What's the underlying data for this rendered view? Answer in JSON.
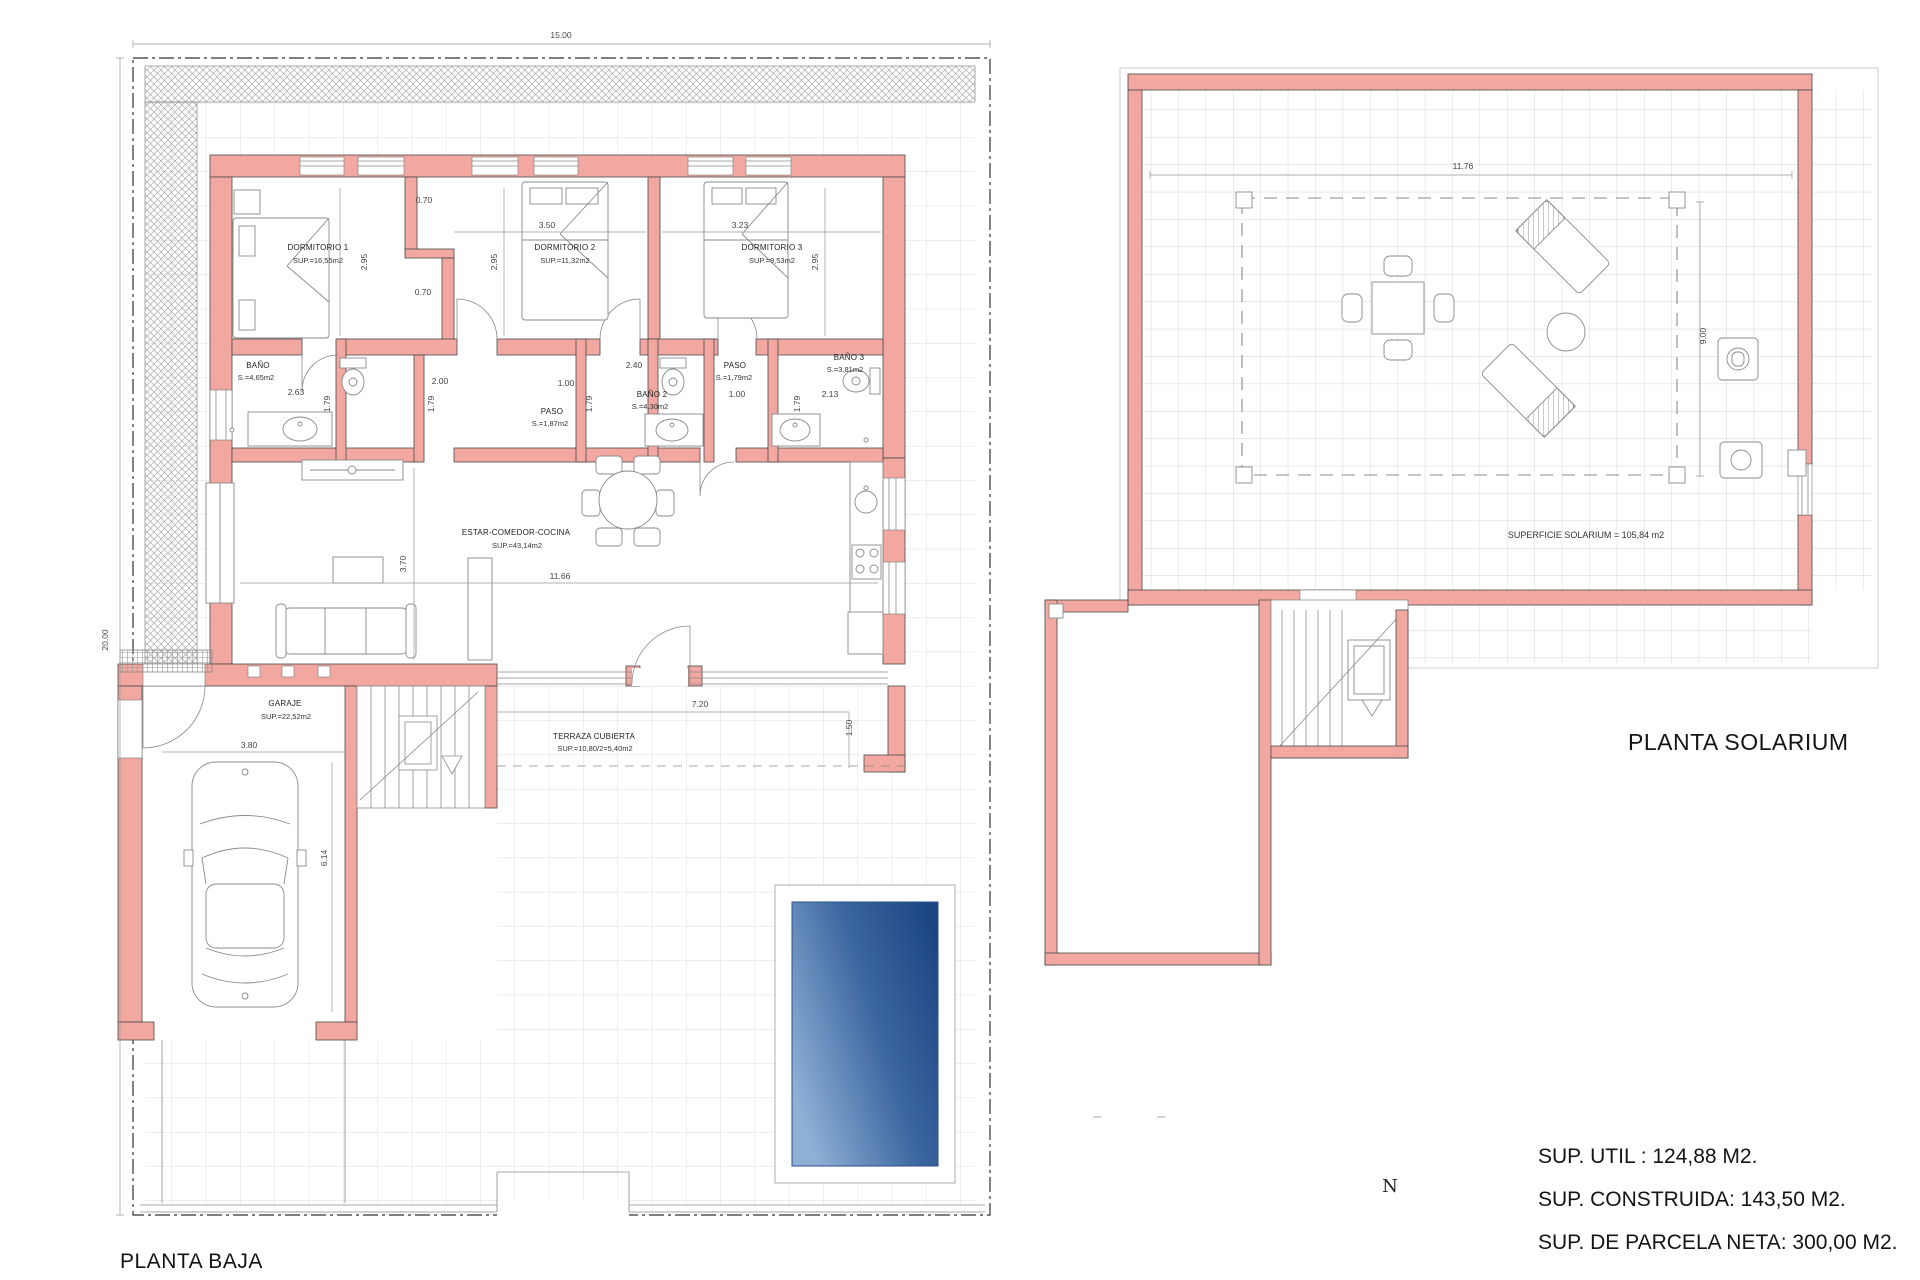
{
  "colors": {
    "wall_fill": "#f2a8a1",
    "pool_light": "#8fb0d6",
    "pool_dark": "#1c4584",
    "grid_line": "#cfcfcf"
  },
  "titles": {
    "ground_floor": "PLANTA BAJA",
    "solarium": "PLANTA SOLARIUM"
  },
  "summary": {
    "util": "SUP. UTIL : 124,88 M2.",
    "construida": "SUP. CONSTRUIDA: 143,50 M2.",
    "parcela": "SUP. DE PARCELA NETA: 300,00 M2."
  },
  "compass": {
    "north": "N"
  },
  "ground_floor": {
    "rooms": {
      "dorm1": {
        "label": "DORMITORIO 1",
        "area": "SUP.=16,55m2"
      },
      "dorm2": {
        "label": "DORMITORIO 2",
        "area": "SUP.=11,32m2"
      },
      "dorm3": {
        "label": "DORMITORIO 3",
        "area": "SUP.=9,53m2"
      },
      "bano1": {
        "label": "BAÑO",
        "area": "S.=4,65m2"
      },
      "bano2": {
        "label": "BAÑO 2",
        "area": "S.=4,30m2"
      },
      "bano3": {
        "label": "BAÑO 3",
        "area": "S.=3,81m2"
      },
      "paso1": {
        "label": "PASO",
        "area": "S.=1,87m2"
      },
      "paso2": {
        "label": "PASO",
        "area": "S.=1,79m2"
      },
      "estar": {
        "label": "ESTAR-COMEDOR-COCINA",
        "area": "SUP.=43,14m2"
      },
      "garaje": {
        "label": "GARAJE",
        "area": "SUP.=22,52m2"
      },
      "terraza": {
        "label": "TERRAZA CUBIERTA",
        "area": "SUP.=10,80/2=5,40m2"
      }
    },
    "dims": {
      "parcel_w": "15.00",
      "parcel_h": "20.00",
      "closet_a": "0.70",
      "closet_b": "0.70",
      "dorm1_h": "2.95",
      "dorm2_h": "2.95",
      "dorm3_h": "2.95",
      "dorm2_w": "3.50",
      "dorm3_w": "3.23",
      "bano1_w": "2.63",
      "bano1_h": "1.79",
      "hall_a": "2.00",
      "hall_b": "1.00",
      "hall_h": "1.79",
      "bano2_w": "2.40",
      "bano2_h": "1.79",
      "paso2_w": "1.00",
      "bano3_w": "2.13",
      "bano3_h": "1.79",
      "estar_h": "3.70",
      "estar_w": "11.66",
      "terraza_w": "7.20",
      "terraza_h": "1.50",
      "garaje_w": "3.80",
      "garaje_h": "6.14"
    }
  },
  "solarium": {
    "surface": "SUPERFICIE SOLARIUM = 105,84 m2",
    "dims": {
      "w": "11.76",
      "h": "9.00"
    }
  }
}
